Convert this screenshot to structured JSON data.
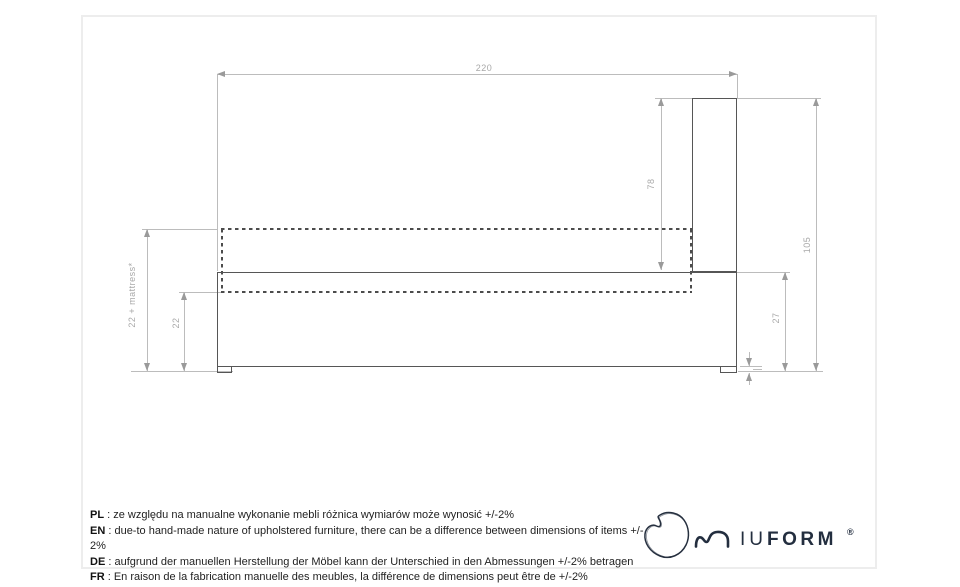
{
  "diagram": {
    "labels": {
      "width": "220",
      "headboard_height": "78",
      "total_height": "105",
      "base_height_right": "27",
      "base_height_left": "22",
      "base_plus_mattress": "22 + mattress*"
    },
    "colors": {
      "outline": "#565656",
      "dashed": "#4c4c4c",
      "dimension_line": "#bcbcbc",
      "dimension_text": "#a8a8a8"
    }
  },
  "notes": {
    "separator": " : ",
    "items": [
      {
        "lang": "PL",
        "text": "ze względu na manualne wykonanie mebli różnica wymiarów może wynosić +/-2%"
      },
      {
        "lang": "EN",
        "text": "due-to hand-made nature of upholstered furniture, there can be a difference between dimensions of items +/- 2%"
      },
      {
        "lang": "DE",
        "text": "aufgrund der manuellen Herstellung der Möbel kann der Unterschied in den Abmessungen +/-2% betragen"
      },
      {
        "lang": "FR",
        "text": "En raison de la fabrication manuelle des meubles, la différence de dimensions peut être de +/-2%"
      }
    ]
  },
  "brand": {
    "name": "MIUFORM",
    "iu": "IU",
    "form": "FORM",
    "registered": "®",
    "color": "#232e3f"
  }
}
